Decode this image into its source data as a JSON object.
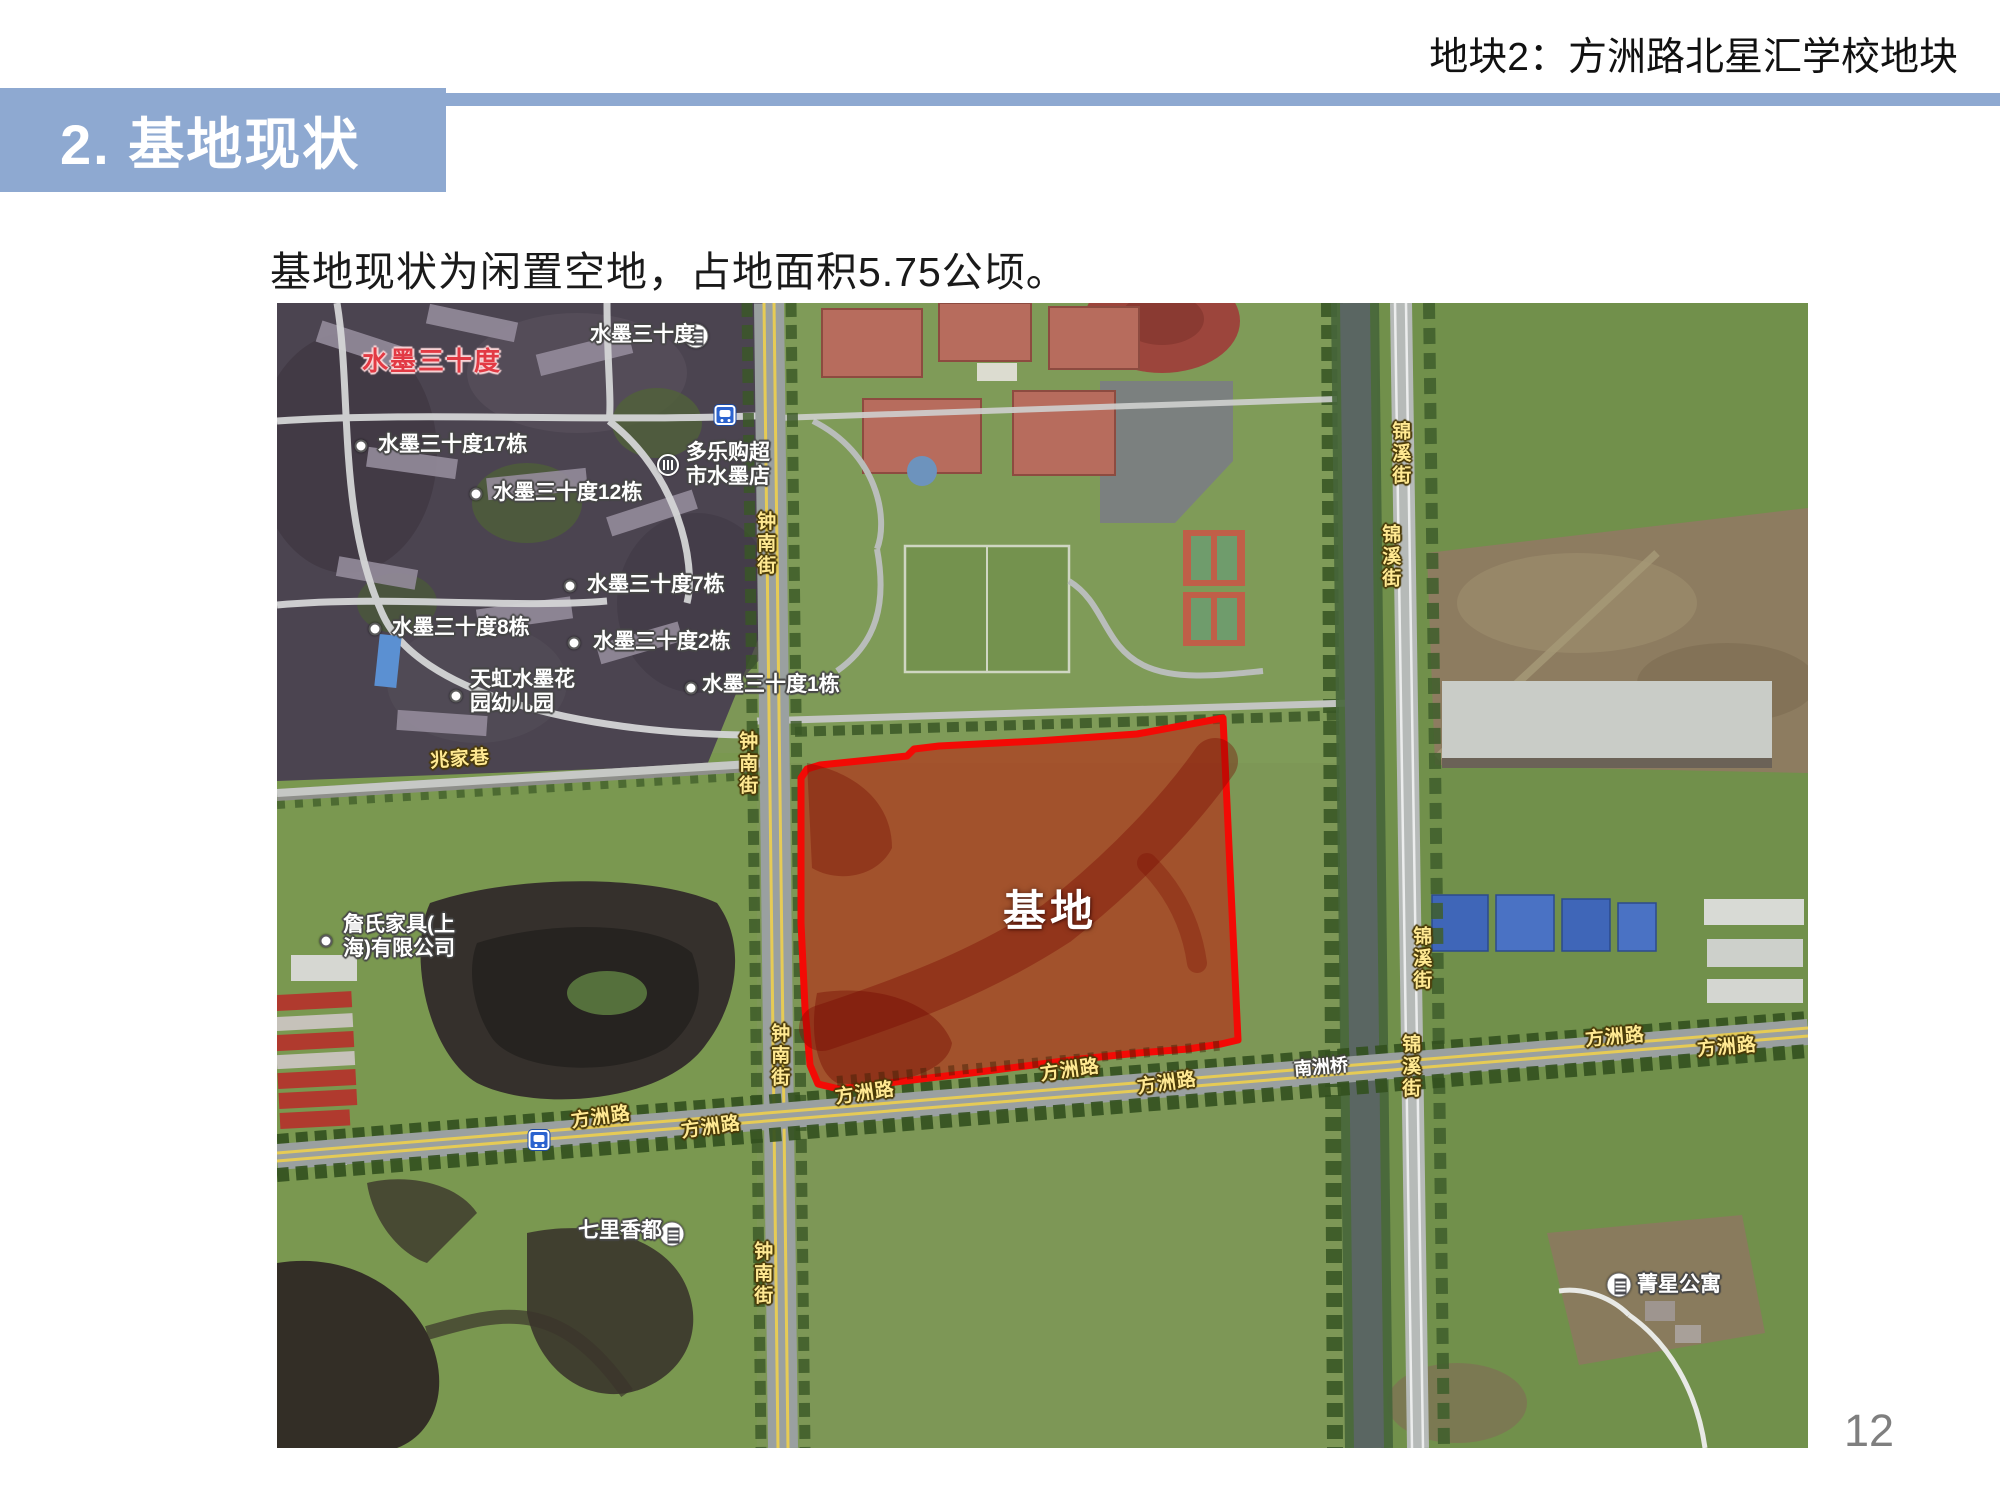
{
  "header": {
    "title": "地块2：方洲路北星汇学校地块"
  },
  "title_bar": {
    "text": "2. 基地现状"
  },
  "body": {
    "text": "基地现状为闲置空地，占地面积5.75公顷。"
  },
  "page_number": "12",
  "colors": {
    "accent_blue": "#8EA9D1",
    "site_fill": "rgba(185,40,20,0.62)",
    "site_border": "#F30A05",
    "road_label_yellow": "#FFE992",
    "poi_label_white": "#FFFFFF",
    "brand_label_red": "#E23A44"
  },
  "map": {
    "site_label": "基地",
    "labels": [
      {
        "t": "水墨三十度",
        "k": "red",
        "x": 85,
        "y": 44,
        "n": "label-shuimo-sanshidu-red"
      },
      {
        "t": "水墨三十度",
        "k": "poi",
        "x": 313,
        "y": 20,
        "icon": "building",
        "ix": 419,
        "iy": 33,
        "n": "label-shuimo-sanshidu"
      },
      {
        "t": "水墨三十度17栋",
        "k": "poi",
        "x": 101,
        "y": 130,
        "dot": [
          84,
          143
        ]
      },
      {
        "t": "水墨三十度12栋",
        "k": "poi",
        "x": 216,
        "y": 178,
        "dot": [
          199,
          191
        ]
      },
      {
        "t": "水墨三十度7栋",
        "k": "poi",
        "x": 310,
        "y": 270,
        "dot": [
          293,
          283
        ]
      },
      {
        "t": "水墨三十度8栋",
        "k": "poi",
        "x": 115,
        "y": 313,
        "dot": [
          98,
          326
        ]
      },
      {
        "t": "水墨三十度2栋",
        "k": "poi",
        "x": 316,
        "y": 327,
        "dot": [
          297,
          340
        ]
      },
      {
        "t": "水墨三十度1栋",
        "k": "poi",
        "x": 425,
        "y": 370,
        "dot": [
          414,
          385
        ]
      },
      {
        "t": "天虹水墨花\n园幼儿园",
        "k": "poi",
        "x": 193,
        "y": 365,
        "dot": [
          179,
          393
        ]
      },
      {
        "t": "多乐购超\n市水墨店",
        "k": "poi",
        "x": 409,
        "y": 138,
        "icon": "shop",
        "ix": 391,
        "iy": 162
      },
      {
        "t": "詹氏家具(上\n海)有限公司",
        "k": "poi",
        "x": 66,
        "y": 610,
        "dot": [
          49,
          638
        ]
      },
      {
        "t": "七里香都",
        "k": "poi",
        "x": 301,
        "y": 916,
        "icon": "building",
        "ix": 395,
        "iy": 931
      },
      {
        "t": "菁星公寓",
        "k": "poi",
        "x": 1360,
        "y": 970,
        "icon": "building",
        "ix": 1342,
        "iy": 982
      },
      {
        "t": "兆家巷",
        "k": "road",
        "x": 153,
        "y": 446,
        "rot": -4
      },
      {
        "t": "钟南街",
        "k": "road",
        "v": 1,
        "x": 477,
        "y": 208
      },
      {
        "t": "钟南街",
        "k": "road",
        "v": 1,
        "x": 459,
        "y": 428
      },
      {
        "t": "钟南街",
        "k": "road",
        "v": 1,
        "x": 491,
        "y": 720
      },
      {
        "t": "钟南街",
        "k": "road",
        "v": 1,
        "x": 474,
        "y": 938
      },
      {
        "t": "锦溪街",
        "k": "road",
        "v": 1,
        "x": 1112,
        "y": 118
      },
      {
        "t": "锦溪街",
        "k": "road",
        "v": 1,
        "x": 1102,
        "y": 221
      },
      {
        "t": "锦溪街",
        "k": "road",
        "v": 1,
        "x": 1133,
        "y": 623
      },
      {
        "t": "锦溪街",
        "k": "road",
        "v": 1,
        "x": 1122,
        "y": 731
      },
      {
        "t": "方洲路",
        "k": "road",
        "x": 294,
        "y": 804,
        "rot": -8
      },
      {
        "t": "方洲路",
        "k": "road",
        "x": 404,
        "y": 814,
        "rot": -8
      },
      {
        "t": "方洲路",
        "k": "road",
        "x": 558,
        "y": 780,
        "rot": -8
      },
      {
        "t": "方洲路",
        "k": "road",
        "x": 763,
        "y": 757,
        "rot": -8
      },
      {
        "t": "方洲路",
        "k": "road",
        "x": 860,
        "y": 770,
        "rot": -8
      },
      {
        "t": "方洲路",
        "k": "road",
        "x": 1308,
        "y": 724,
        "rot": -5
      },
      {
        "t": "方洲路",
        "k": "road",
        "x": 1420,
        "y": 734,
        "rot": -5
      },
      {
        "t": "南洲桥",
        "k": "bridge",
        "x": 1017,
        "y": 754,
        "rot": -5
      },
      {
        "t": "",
        "k": "icononly",
        "icon": "metro",
        "ix": 448,
        "iy": 112
      },
      {
        "t": "",
        "k": "icononly",
        "icon": "metro",
        "ix": 262,
        "iy": 837
      }
    ]
  }
}
